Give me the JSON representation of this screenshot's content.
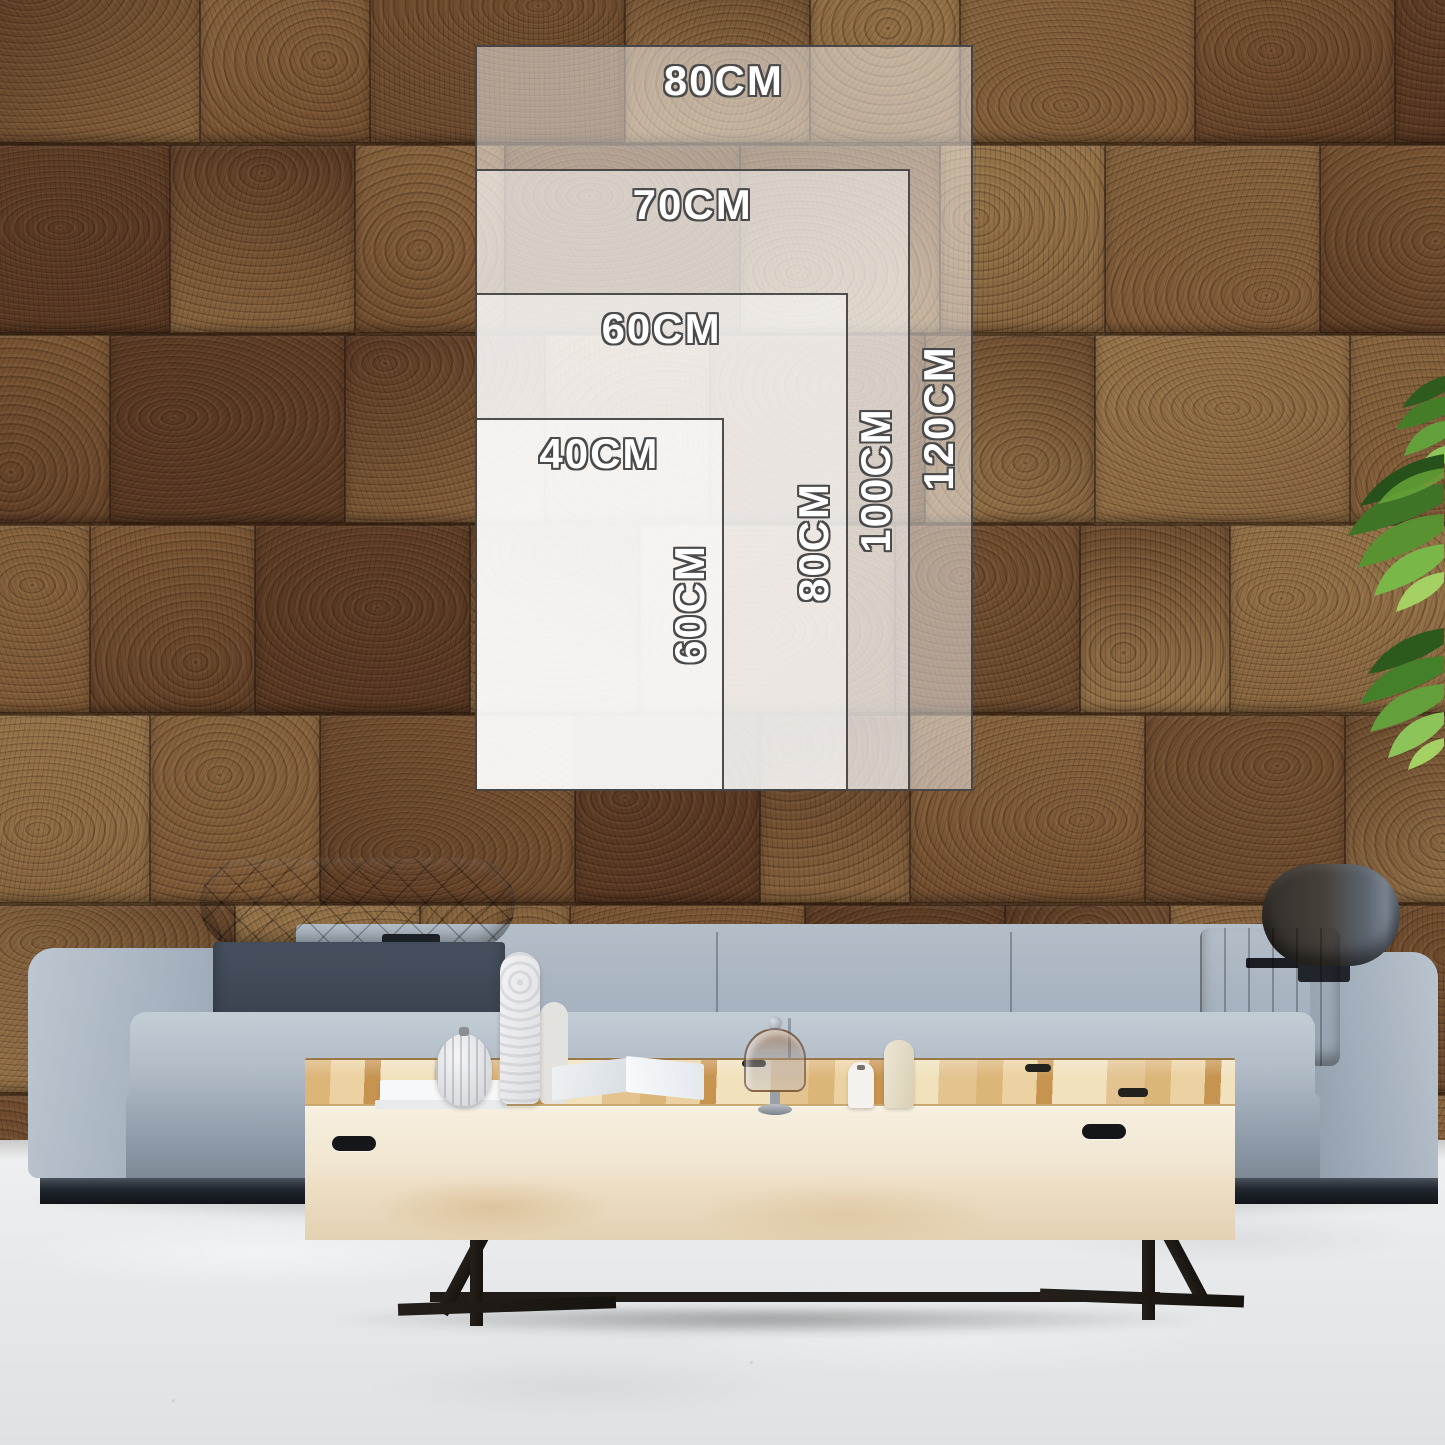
{
  "image": {
    "width_px": 1445,
    "height_px": 1445,
    "description": "Living room wall-art size guide: semi-transparent nested rectangles on an end-grain wood block wall above a gray sofa and wooden coffee table"
  },
  "size_guide": {
    "unit": "CM",
    "px_per_cm": 6.22,
    "anchor_left_px": 475,
    "anchor_bottom_px": 791,
    "fill": "rgba(255,255,255,0.48)",
    "border_color": "rgba(60,60,60,0.9)",
    "label_text_color": "#ffffff",
    "label_outline_color": "#4a4a4a",
    "sizes": [
      {
        "width_cm": 80,
        "height_cm": 120,
        "width_label": "80CM",
        "height_label": "120CM"
      },
      {
        "width_cm": 70,
        "height_cm": 100,
        "width_label": "70CM",
        "height_label": "100CM"
      },
      {
        "width_cm": 60,
        "height_cm": 80,
        "width_label": "60CM",
        "height_label": "80CM"
      },
      {
        "width_cm": 40,
        "height_cm": 60,
        "width_label": "40CM",
        "height_label": "60CM"
      }
    ]
  },
  "scene": {
    "wall_palette": [
      "#573722",
      "#6b4a2e",
      "#7d5836",
      "#8a6640",
      "#96744a",
      "#5e3d25",
      "#714d2f",
      "#86643e"
    ],
    "floor_color": "#e9ebec",
    "sofa_fabric_color": "#a9b4c0",
    "sofa_dark_cushion_color": "#3d4653",
    "right_headrest_color": "#4a4540",
    "table_wood_color": "#e3c38f",
    "table_body_color": "#f0e8d6",
    "table_leg_color": "#1b1815",
    "plant_leaf_colors": [
      "#27511a",
      "#3f7326",
      "#6aa83a",
      "#a5d063"
    ]
  }
}
